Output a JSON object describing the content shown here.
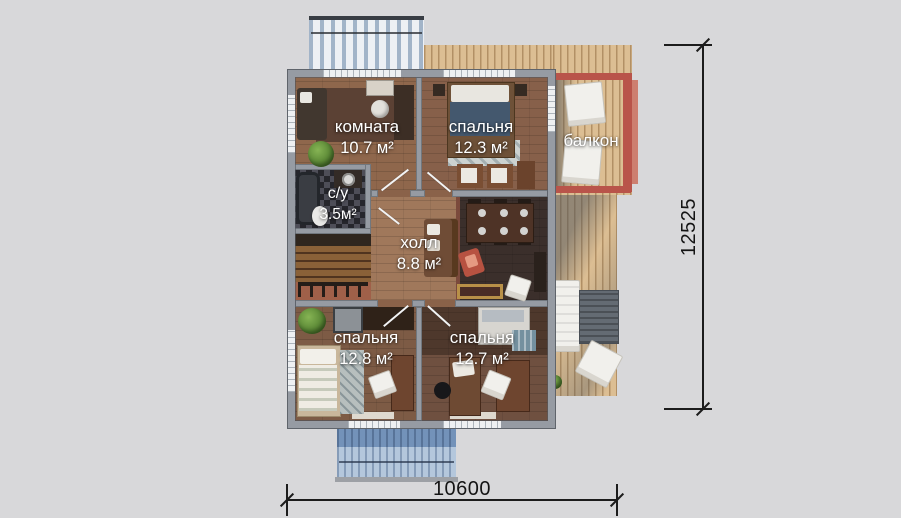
{
  "rooms": [
    {
      "name": "комната",
      "area": "10.7 м²"
    },
    {
      "name": "спальня",
      "area": "12.3 м²"
    },
    {
      "name": "балкон",
      "area": ""
    },
    {
      "name": "с/у",
      "area": "3.5м²"
    },
    {
      "name": "холл",
      "area": "8.8 м²"
    },
    {
      "name": "спальня",
      "area": "12.8 м²"
    },
    {
      "name": "спальня",
      "area": "12.7 м²"
    }
  ],
  "dimensions": {
    "height_total": "12525",
    "width_total": "10600"
  },
  "colors": {
    "background": "#d8d8da",
    "wall_gray": "#969ba3",
    "deck_wood": "#dcbe93",
    "balcony_rail_red": "#b9544a",
    "roof_blue": "#7392b9",
    "label_text": "#ffffff",
    "dimension_ink": "#1c1c1c"
  }
}
